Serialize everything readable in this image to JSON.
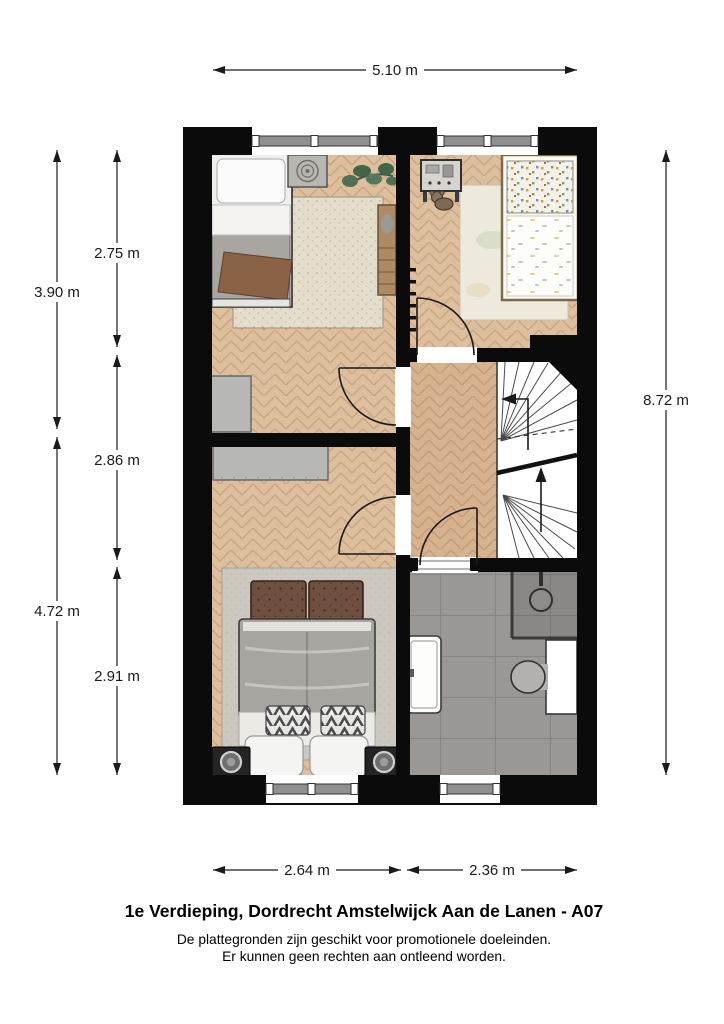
{
  "page": {
    "title": "1e Verdieping, Dordrecht Amstelwijck Aan de Lanen - A07",
    "disclaimer": {
      "line1": "De plattegronden zijn geschikt voor promotionele doeleinden.",
      "line2": "Er kunnen geen rechten aan ontleend worden."
    }
  },
  "dimensions": {
    "top_width": "5.10 m",
    "left_upper_total": "3.90 m",
    "left_lower_total": "4.72 m",
    "room_top_height": "2.75 m",
    "room_middle_height": "2.86 m",
    "room_bottom_height": "2.91 m",
    "right_total_height": "8.72 m",
    "bottom_left_width": "2.64 m",
    "bottom_right_width": "2.36 m"
  },
  "colors": {
    "wall": "#0b0b0b",
    "wood_floor": "#ddbf9e",
    "landing_floor": "#d6b28e",
    "bathroom_tile": "#9b9794",
    "stair_fill": "#ffffff",
    "dimension_line": "#1a1a1a"
  }
}
